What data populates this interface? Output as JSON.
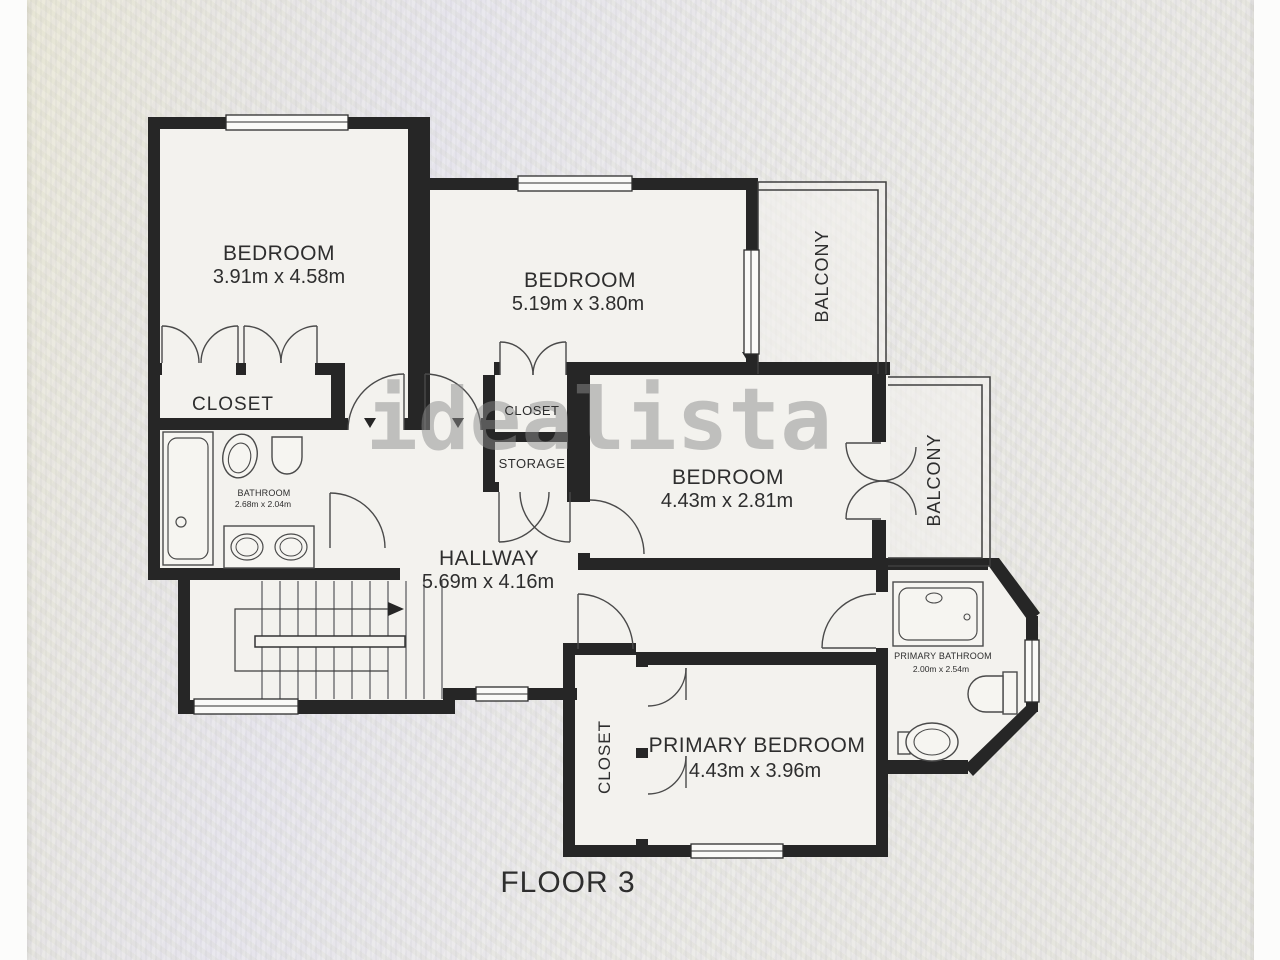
{
  "page": {
    "floor_title": "FLOOR 3",
    "watermark": "idealista"
  },
  "rooms": {
    "bedroom1": {
      "label": "BEDROOM",
      "dims": "3.91m x 4.58m"
    },
    "bedroom2": {
      "label": "BEDROOM",
      "dims": "5.19m x 3.80m"
    },
    "bedroom3": {
      "label": "BEDROOM",
      "dims": "4.43m x 2.81m"
    },
    "primary_bedroom": {
      "label": "PRIMARY BEDROOM",
      "dims": "4.43m x 3.96m"
    },
    "hallway": {
      "label": "HALLWAY",
      "dims": "5.69m x 4.16m"
    },
    "bathroom": {
      "label": "BATHROOM",
      "dims": "2.68m x 2.04m"
    },
    "primary_bathroom": {
      "label": "PRIMARY BATHROOM",
      "dims": "2.00m x 2.54m"
    },
    "closet_bedroom1": {
      "label": "CLOSET"
    },
    "closet_hall": {
      "label": "CLOSET"
    },
    "storage": {
      "label": "STORAGE"
    },
    "closet_primary": {
      "label": "CLOSET"
    },
    "balcony_top": {
      "label": "BALCONY"
    },
    "balcony_right": {
      "label": "BALCONY"
    }
  },
  "colors": {
    "wall": "#262626",
    "thin_line": "#3f3f3f",
    "paper": "#f3f2ee",
    "background": "#eae9e6",
    "watermark": "#8d8d8d",
    "text": "#2e2e2e"
  }
}
